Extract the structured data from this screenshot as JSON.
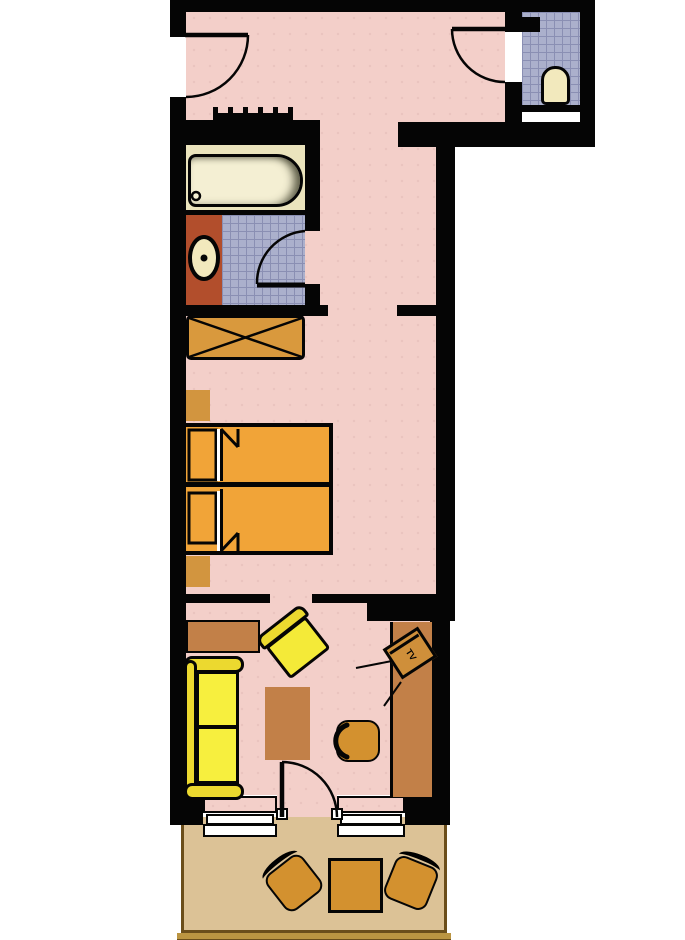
{
  "diagram": {
    "type": "floor-plan",
    "title": "apartment-floor-plan",
    "tv_label": "TV",
    "rooms": [
      {
        "name": "entrance-hall",
        "floor": "pink"
      },
      {
        "name": "wc",
        "floor": "blue-tile"
      },
      {
        "name": "bathroom",
        "floor": "blue-tile"
      },
      {
        "name": "corridor",
        "floor": "pink"
      },
      {
        "name": "bedroom",
        "floor": "pink"
      },
      {
        "name": "living-area",
        "floor": "pink"
      },
      {
        "name": "balcony",
        "floor": "tan"
      }
    ],
    "furniture": [
      "entry-door",
      "coat-rack",
      "wc-door",
      "toilet",
      "bathtub",
      "washbasin",
      "bathroom-door",
      "wardrobe",
      "nightstand",
      "double-bed",
      "nightstand",
      "sideboard",
      "armchair",
      "sofa",
      "coffee-table",
      "tv",
      "desk",
      "desk-chair",
      "balcony-door",
      "window",
      "window",
      "balcony-chair",
      "balcony-table",
      "balcony-chair"
    ],
    "colors": {
      "wall": "#050505",
      "floor_pink": "#f3cfc9",
      "tile_blue": "#abb0cc",
      "tile_grid": "#8a8fb3",
      "bathroom_cream": "#ebe4bd",
      "tub_fill": "#f4efd3",
      "vanity_terracotta": "#b24e2c",
      "fixture_cream": "#f2e9bd",
      "wardrobe_orange": "#d9993d",
      "bed_orange": "#f1a438",
      "nightstand_orange": "#d2953f",
      "case_goods_brown": "#c28048",
      "chair_orange": "#d3912f",
      "tv_orange": "#cf8f3a",
      "sofa_frame_yellow": "#ecd92f",
      "sofa_cushion_yellow": "#f7ef3e",
      "balcony_floor": "#dcc296",
      "balcony_edge": "#6b4e1b",
      "balcony_band": "#bb9542",
      "window_sill": "#ffffff"
    }
  }
}
